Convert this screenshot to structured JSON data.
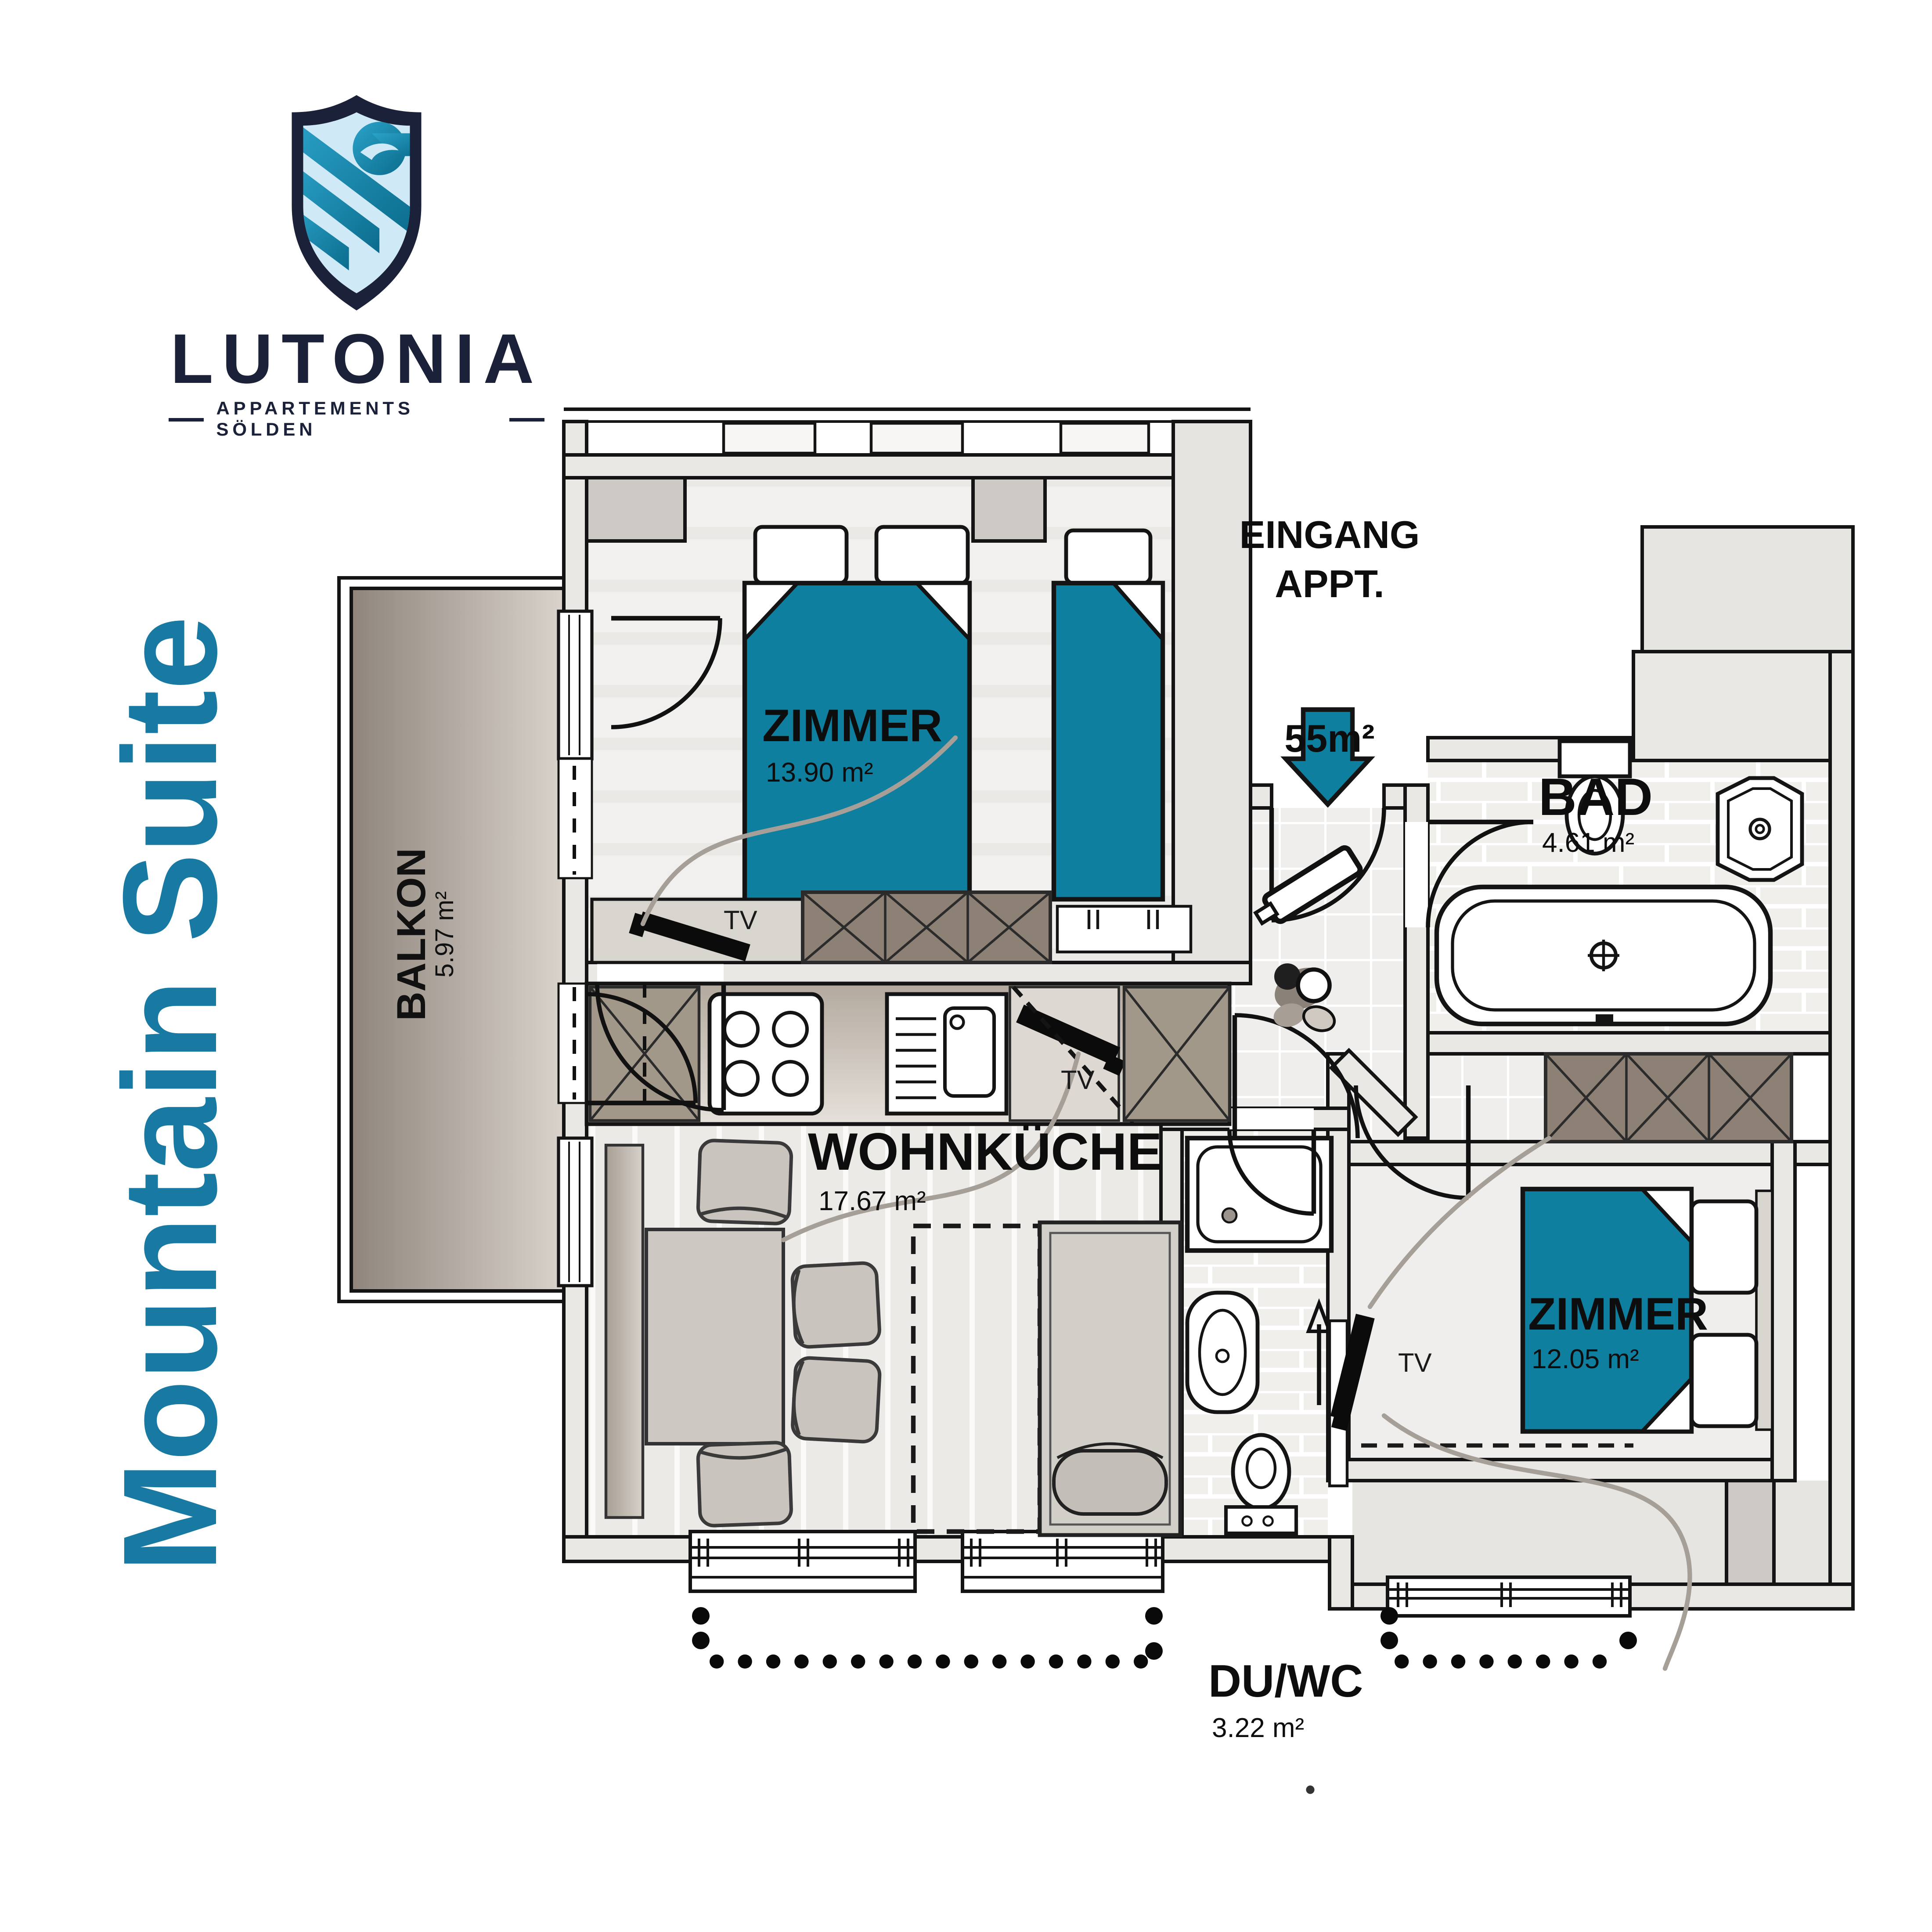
{
  "brand": {
    "name": "LUTONIA",
    "tagline": "APPARTEMENTS SÖLDEN"
  },
  "suite_title": "Mountain Suite",
  "entrance": {
    "label_line1": "EINGANG",
    "label_line2": "APPT.",
    "area": "55m²"
  },
  "rooms": {
    "bedroom_top": {
      "name": "ZIMMER",
      "area": "13.90 m²"
    },
    "bedroom_right": {
      "name": "ZIMMER",
      "area": "12.05 m²"
    },
    "bath": {
      "name": "BAD",
      "area": "4.61 m²"
    },
    "living_kitchen": {
      "name": "WOHNKÜCHE",
      "area": "17.67 m²"
    },
    "balcony": {
      "name": "BALKON",
      "area": "5.97 m²"
    },
    "shower_wc": {
      "name": "DU/WC",
      "area": "3.22 m²"
    }
  },
  "fixtures": {
    "tv": "TV"
  },
  "colors": {
    "accent_teal": "#0f7fa0",
    "brand_navy": "#1b2138",
    "title_teal": "#1879a2"
  }
}
